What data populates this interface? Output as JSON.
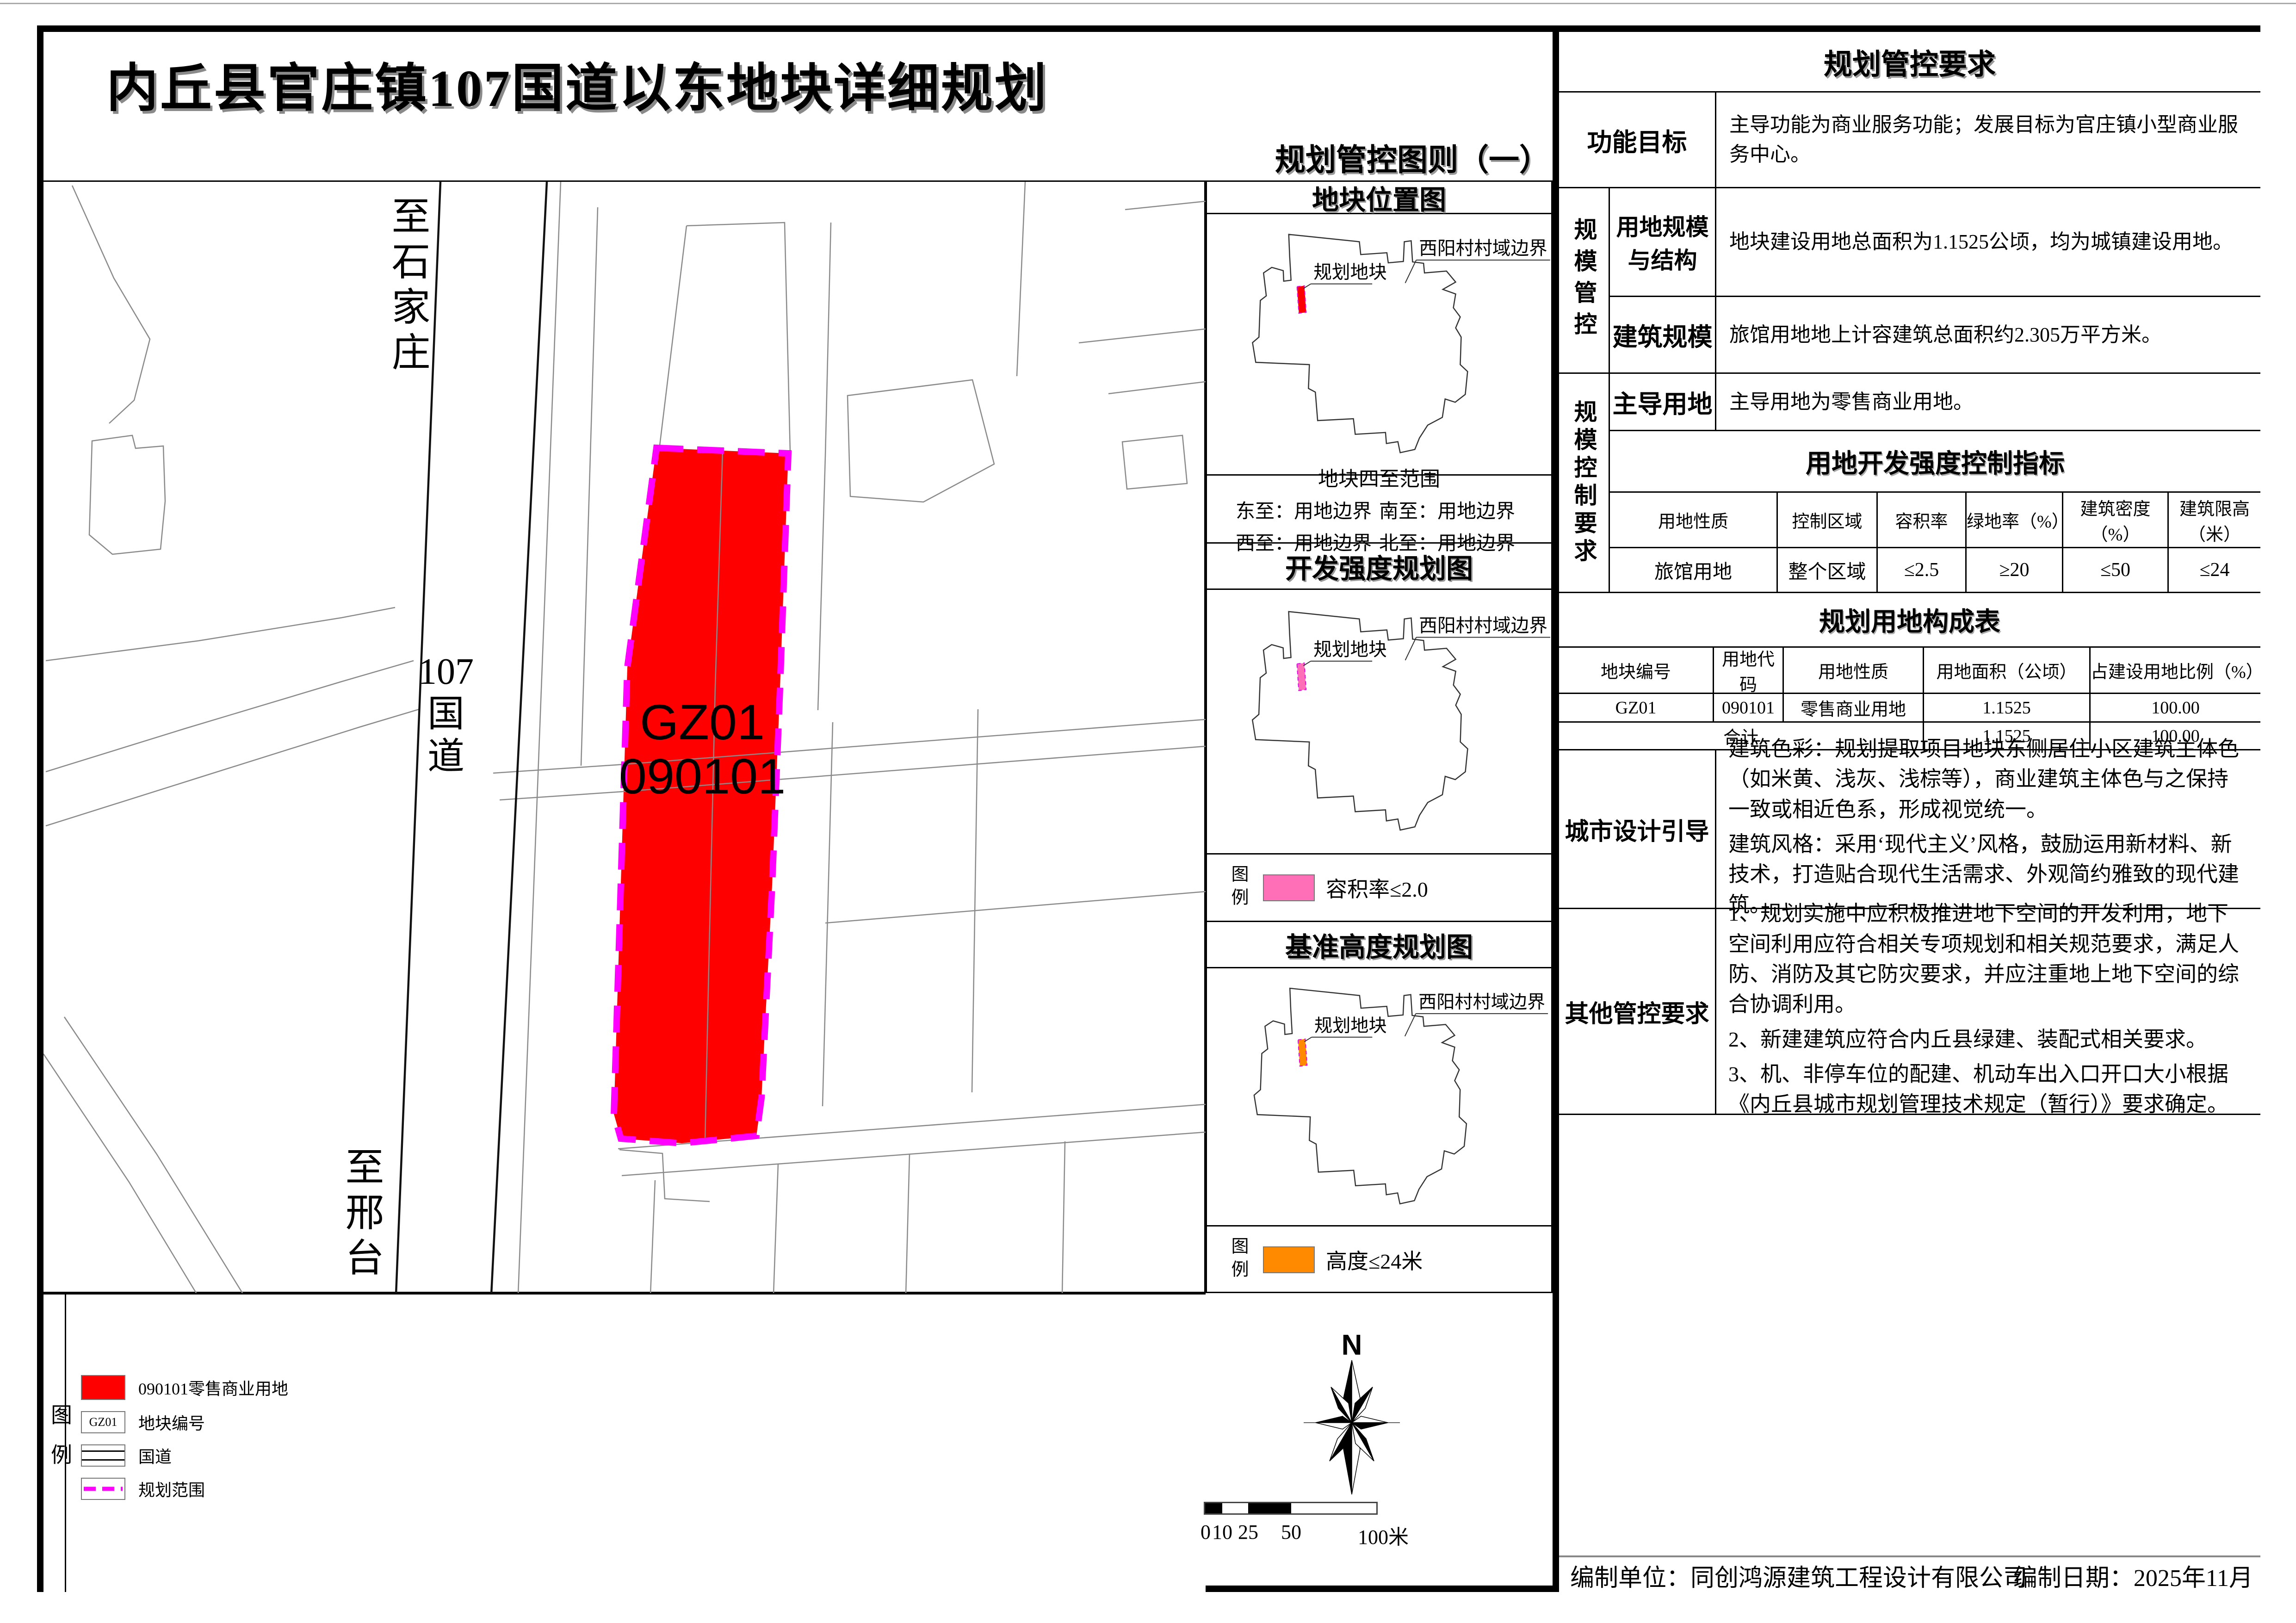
{
  "title": "内丘县官庄镇107国道以东地块详细规划",
  "sheet_label": "规划管控图则（一）",
  "colors": {
    "plot_red": "#fe0000",
    "plan_boundary_magenta": "#ff00ff",
    "far_pink": "#ff6fb7",
    "height_orange": "#ff8a00"
  },
  "main_map": {
    "dest_top": "至石家庄",
    "road_lines": [
      "107",
      "国",
      "道"
    ],
    "dest_bottom": "至邢台",
    "plot_code": "GZ01",
    "plot_use": "090101"
  },
  "mini_maps": [
    {
      "title": "地块位置图",
      "boundary_label": "西阳村村域边界",
      "plot_label": "规划地块",
      "plot_color": "#ff0000"
    },
    {
      "title": "开发强度规划图",
      "boundary_label": "西阳村村域边界",
      "plot_label": "规划地块",
      "plot_color": "#ff6fb7",
      "legend": {
        "label": "图例",
        "text": "容积率≤2.0"
      }
    },
    {
      "title": "基准高度规划图",
      "boundary_label": "西阳村村域边界",
      "plot_label": "规划地块",
      "plot_color": "#ff8a00",
      "legend": {
        "label": "图例",
        "text": "高度≤24米"
      }
    }
  ],
  "extent": {
    "title": "地块四至范围",
    "items": [
      "东至：用地边界",
      "南至：用地边界",
      "西至：用地边界",
      "北至：用地边界"
    ]
  },
  "legend": {
    "label": "图例",
    "items": [
      {
        "text": "090101零售商业用地",
        "color": "#fe0000"
      },
      {
        "code": "GZ01",
        "text": "地块编号"
      },
      {
        "text": "国道"
      },
      {
        "text": "规划范围",
        "color": "#ff00ff"
      }
    ]
  },
  "north_label": "N",
  "scale_ticks": [
    "0",
    "10",
    "25",
    "50",
    "100米"
  ],
  "control_table": {
    "title": "规划管控要求",
    "function_goal": {
      "label": "功能目标",
      "text": "主导功能为商业服务功能；发展目标为官庄镇小型商业服务中心。"
    },
    "scale_group_label": "规模管控",
    "land_scale": {
      "label": "用地规模与结构",
      "text": "地块建设用地总面积为1.1525公顷，均为城镇建设用地。"
    },
    "building_scale": {
      "label": "建筑规模",
      "text": "旅馆用地地上计容建筑总面积约2.305万平方米。"
    },
    "control_group_label": "规模控制要求",
    "dominant_use": {
      "label": "主导用地",
      "text": "主导用地为零售商业用地。"
    },
    "intensity": {
      "title": "用地开发强度控制指标",
      "headers": [
        "用地性质",
        "控制区域",
        "容积率",
        "绿地率（%）",
        "建筑密度（%）",
        "建筑限高（米）"
      ],
      "row": [
        "旅馆用地",
        "整个区域",
        "≤2.5",
        "≥20",
        "≤50",
        "≤24"
      ]
    },
    "composition": {
      "title": "规划用地构成表",
      "headers": [
        "地块编号",
        "用地代码",
        "用地性质",
        "用地面积（公顷）",
        "占建设用地比例（%）"
      ],
      "row1": [
        "GZ01",
        "090101",
        "零售商业用地",
        "1.1525",
        "100.00"
      ],
      "total_label": "合计",
      "total_area": "1.1525",
      "total_ratio": "100.00"
    },
    "urban_design": {
      "label": "城市设计引导",
      "paragraphs": [
        "建筑色彩：规划提取项目地块东侧居住小区建筑主体色（如米黄、浅灰、浅棕等），商业建筑主体色与之保持一致或相近色系，形成视觉统一。",
        "建筑风格：采用‘现代主义’风格，鼓励运用新材料、新技术，打造贴合现代生活需求、外观简约雅致的现代建筑。"
      ]
    },
    "other_requirements": {
      "label": "其他管控要求",
      "paragraphs": [
        "1、规划实施中应积极推进地下空间的开发利用，地下空间利用应符合相关专项规划和相关规范要求，满足人防、消防及其它防灾要求，并应注重地上地下空间的综合协调利用。",
        "2、新建建筑应符合内丘县绿建、装配式相关要求。",
        "3、机、非停车位的配建、机动车出入口开口大小根据《内丘县城市规划管理技术规定（暂行）》要求确定。"
      ]
    }
  },
  "footer": {
    "left": "编制单位：同创鸿源建筑工程设计有限公司",
    "right": "编制日期：2025年11月"
  }
}
